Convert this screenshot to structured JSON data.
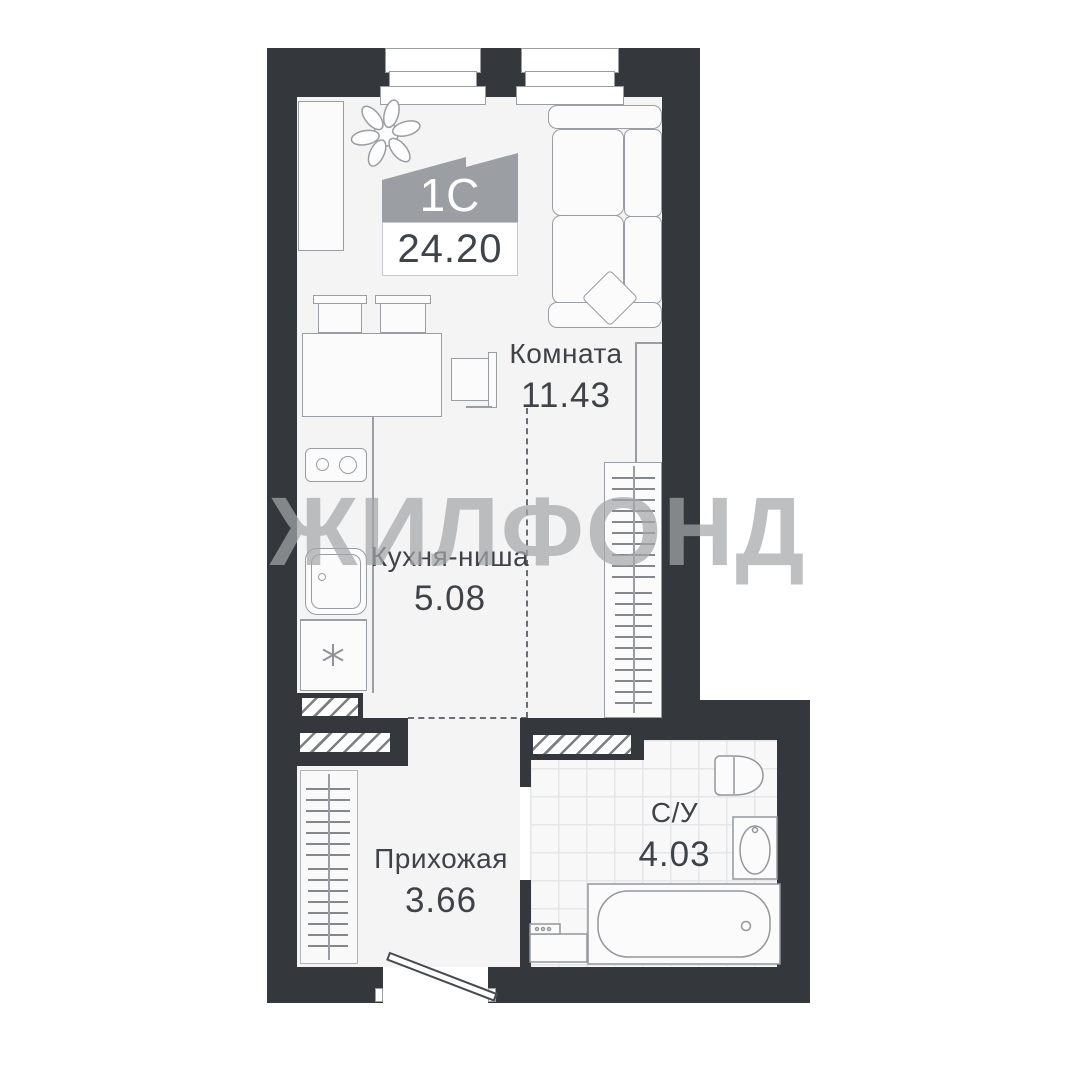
{
  "watermark": "ЖИЛФОНД",
  "apartment": {
    "type_label": "1С",
    "total_area": "24.20"
  },
  "rooms": [
    {
      "name": "Комната",
      "area": "11.43"
    },
    {
      "name": "Кухня-ниша",
      "area": "5.08"
    },
    {
      "name": "Прихожая",
      "area": "3.66"
    },
    {
      "name": "С/У",
      "area": "4.03"
    }
  ],
  "icons": {
    "fridge": "snowflake-icon",
    "plant": "plant-icon",
    "hatch": "vent-shaft-hatch"
  },
  "colors": {
    "wall": "#34373c",
    "floor": "#f4f4f5",
    "line": "#9a9da1",
    "label_text": "#3f4247",
    "logo_gray": "#9b9ea2",
    "watermark_gray": "#a4a6a9"
  }
}
